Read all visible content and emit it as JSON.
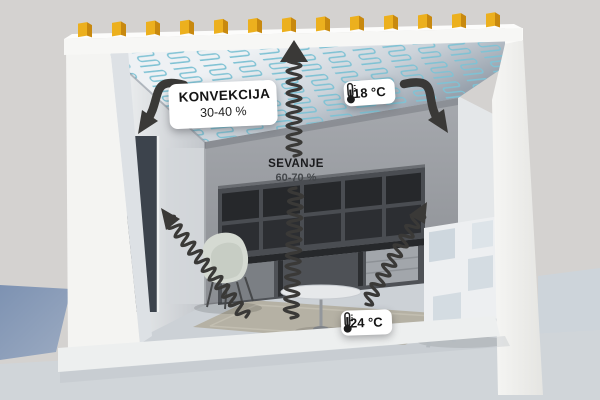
{
  "diagram": {
    "type": "ceiling-heating-room-cutaway",
    "labels": {
      "convection": {
        "title": "KONVEKCIJA",
        "value": "30-40 %"
      },
      "radiation": {
        "title": "SEVANJE",
        "value": "60-70 %"
      },
      "ceiling_temp": {
        "value": "18 °C",
        "icon": "thermometer-icon"
      },
      "floor_temp": {
        "value": "24 °C",
        "icon": "thermometer-icon"
      }
    },
    "colors": {
      "background": "#d4d2d0",
      "ground_blue": "#8094b4",
      "heating_pipes": "#7fc2d4",
      "joists_yellow": "#ecb01e",
      "arrows": "#3a3937",
      "label_background": "#ffffff"
    }
  }
}
